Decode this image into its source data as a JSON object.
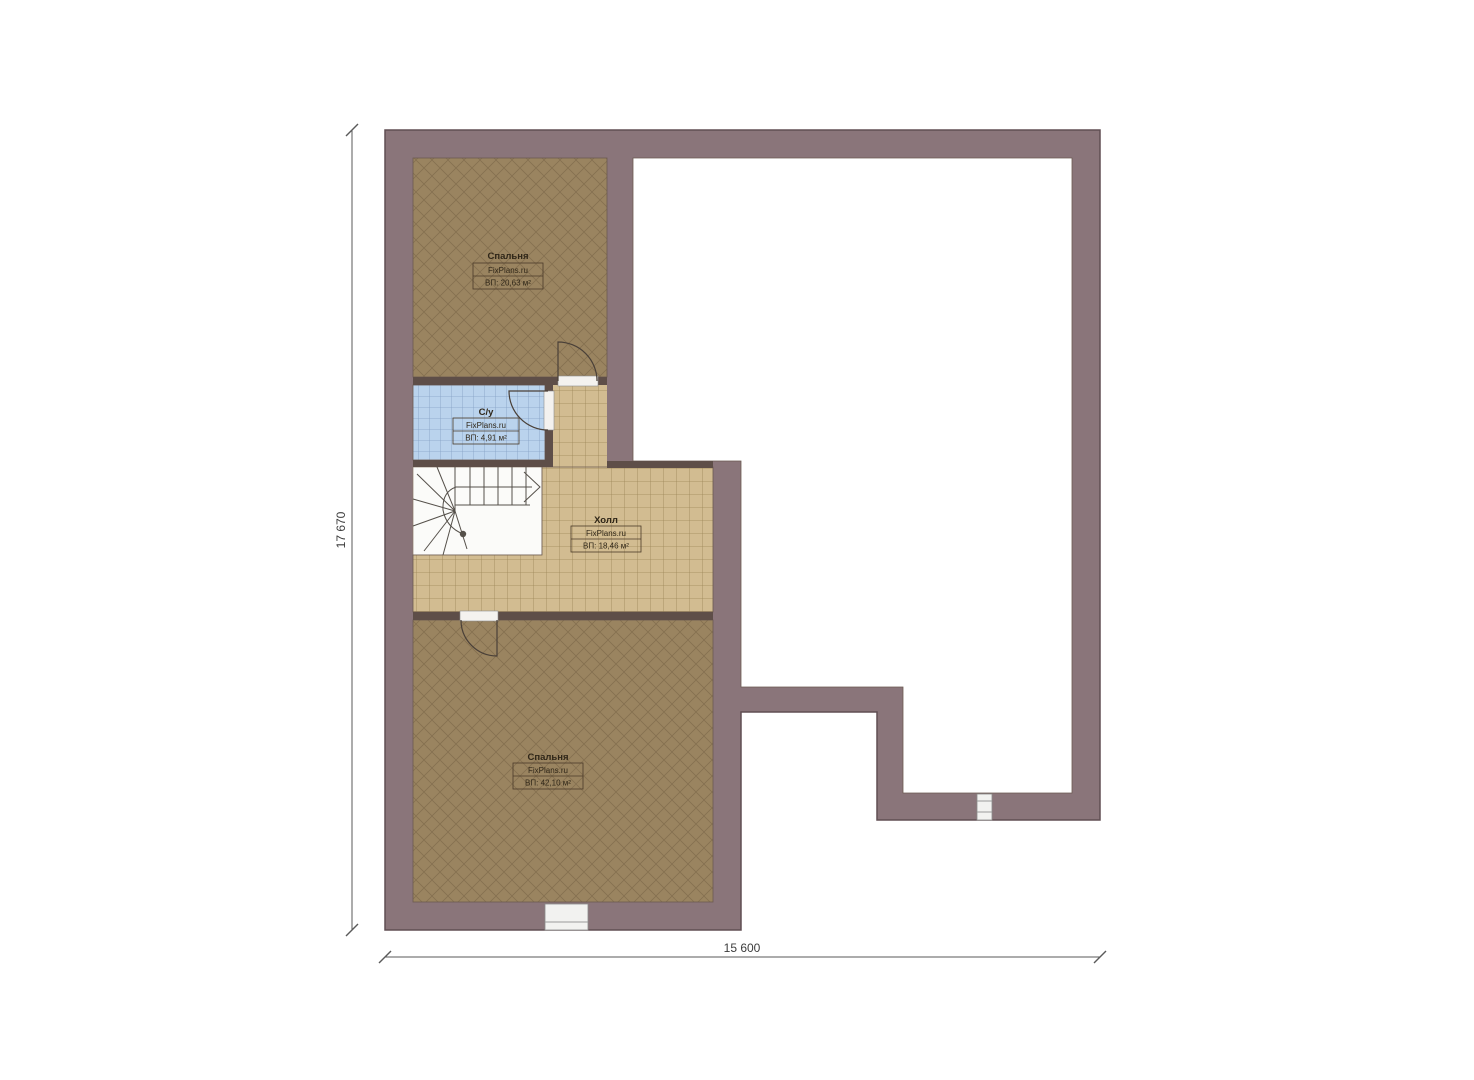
{
  "page": {
    "background": "#ffffff",
    "type_note": "architectural floor plan, upper storey"
  },
  "plan": {
    "rooms": [
      {
        "id": "bedroom-top",
        "name": "Спальня",
        "watermark": "FixPlans.ru",
        "area": "ВП: 20,63 м²"
      },
      {
        "id": "bathroom",
        "name": "С/у",
        "watermark": "FixPlans.ru",
        "area": "ВП: 4,91 м²"
      },
      {
        "id": "hall",
        "name": "Холл",
        "watermark": "FixPlans.ru",
        "area": "ВП: 18,46 м²"
      },
      {
        "id": "bedroom-bottom",
        "name": "Спальня",
        "watermark": "FixPlans.ru",
        "area": "ВП: 42,10 м²"
      }
    ],
    "dimensions": {
      "vertical_label": "17 670",
      "horizontal_label": "15 600"
    },
    "colors": {
      "wall": "#8a757a",
      "wall_outline": "#604e53",
      "partition_wall": "#5e4e48",
      "bedroom_floor": "#9a8460",
      "bedroom_hatch": "#857050",
      "hall_floor": "#d2bc91",
      "hall_grid": "#9d8557",
      "bathroom_floor": "#bad3ed",
      "bathroom_grid": "#84a0c4",
      "stair_lines": "#55504a",
      "dimension_line": "#5a5a5a",
      "label_text": "#2f2618"
    }
  }
}
